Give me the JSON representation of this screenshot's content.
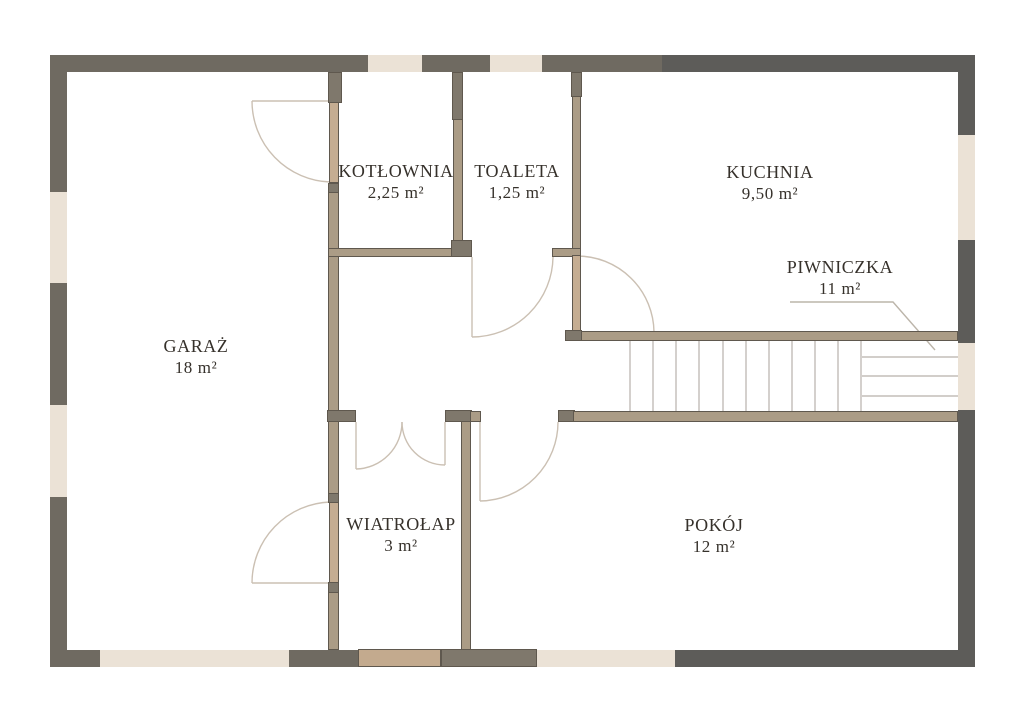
{
  "plan_title": "House floor plan",
  "rooms": [
    {
      "id": "kotlownia",
      "name": "KOTŁOWNIA",
      "area": "2,25 m²"
    },
    {
      "id": "toaleta",
      "name": "TOALETA",
      "area": "1,25 m²"
    },
    {
      "id": "kuchnia",
      "name": "KUCHNIA",
      "area": "9,50 m²"
    },
    {
      "id": "piwniczka",
      "name": "PIWNICZKA",
      "area": "11 m²"
    },
    {
      "id": "garaz",
      "name": "GARAŻ",
      "area": "18 m²"
    },
    {
      "id": "wiatrolap",
      "name": "WIATROŁAP",
      "area": "3 m²"
    },
    {
      "id": "pokoj",
      "name": "POKÓJ",
      "area": "12 m²"
    }
  ],
  "colors": {
    "wall_exterior": "#6f6a61",
    "wall_exterior_dark": "#5d5c59",
    "wall_cap": "#7f786c",
    "wall_interior": "#ab9c86",
    "wall_outline": "#5f584e",
    "door_leaf": "#c5ad92",
    "entry_door": "#c3aa8e",
    "window": "#ebe2d6",
    "door_arc": "#cbc0b3",
    "stairs_line": "#b6b1ab",
    "leader_line": "#bcb5aa",
    "text": "#36312b",
    "background": "#ffffff"
  }
}
